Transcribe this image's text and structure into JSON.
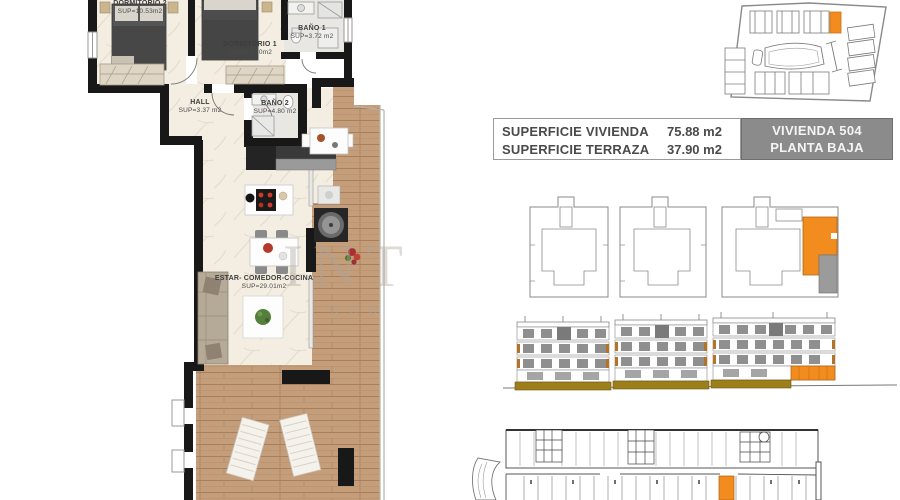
{
  "floor_plan": {
    "rooms": [
      {
        "name": "DORMITORIO 2",
        "sup": "SUP=10.53m2"
      },
      {
        "name": "DORMITORIO 1",
        "sup": "SUP=11.70m2"
      },
      {
        "name": "BAÑO 1",
        "sup": "SUP=3.72 m2"
      },
      {
        "name": "HALL",
        "sup": "SUP=3.37 m2"
      },
      {
        "name": "BAÑO 2",
        "sup": "SUP=4.80 m2"
      },
      {
        "name": "ESTAR- COMEDOR-COCINA",
        "sup": "SUP=29.01m2"
      }
    ],
    "watermark_line1": "INT",
    "watermark_line2": "WWW"
  },
  "summary": {
    "rows": [
      {
        "label": "SUPERFICIE VIVIENDA",
        "value": "75.88 m2"
      },
      {
        "label": "SUPERFICIE TERRAZA",
        "value": "37.90 m2"
      }
    ],
    "unit_label": "VIVIENDA 504",
    "floor_label": "PLANTA BAJA"
  },
  "colors": {
    "highlight_orange": "#F28C1E",
    "unit_box_gray": "#8B8B8B",
    "wall_black": "#181818",
    "floor_cream": "#F3EDE2",
    "bath_gray": "#E9E7E2",
    "terrace_wood": "#C49D7A",
    "elevation_base_khaki": "#9C7E1B"
  }
}
